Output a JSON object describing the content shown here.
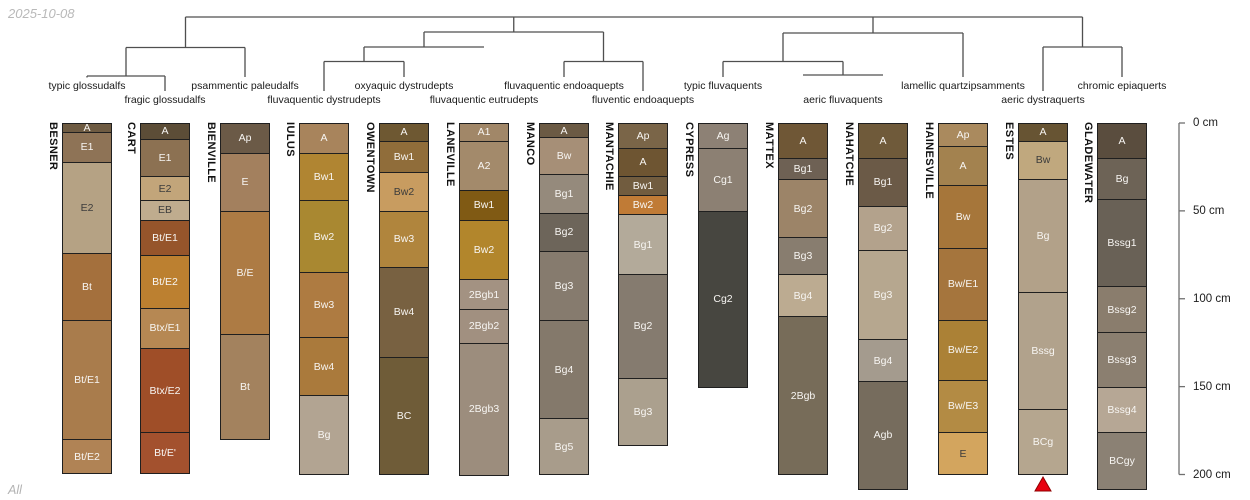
{
  "window": {
    "date": "2025-10-08",
    "footer": "All"
  },
  "dendrogram": {
    "line_color": "#4f4f4f",
    "taxa": [
      {
        "label": "typic glossudalfs",
        "x": 87,
        "row": 1
      },
      {
        "label": "fragic glossudalfs",
        "x": 165,
        "row": 2
      },
      {
        "label": "psammentic paleudalfs",
        "x": 245,
        "row": 1
      },
      {
        "label": "fluvaquentic dystrudepts",
        "x": 324,
        "row": 2
      },
      {
        "label": "oxyaquic dystrudepts",
        "x": 404,
        "row": 1
      },
      {
        "label": "fluvaquentic eutrudepts",
        "x": 484,
        "row": 2
      },
      {
        "label": "fluvaquentic endoaquepts",
        "x": 564,
        "row": 1
      },
      {
        "label": "fluventic endoaquepts",
        "x": 643,
        "row": 2
      },
      {
        "label": "typic fluvaquents",
        "x": 723,
        "row": 1
      },
      {
        "label": "aeric fluvaquents",
        "x": 843,
        "row": 2
      },
      {
        "label": "lamellic quartzipsamments",
        "x": 963,
        "row": 1
      },
      {
        "label": "aeric dystraquerts",
        "x": 1043,
        "row": 2
      },
      {
        "label": "chromic epiaquerts",
        "x": 1122,
        "row": 1
      }
    ],
    "links": {
      "h": [
        [
          17,
          185.5,
          1082.5
        ],
        [
          47.5,
          126,
          245
        ],
        [
          76,
          87,
          165
        ],
        [
          47,
          364,
          484
        ],
        [
          61.5,
          324,
          404
        ],
        [
          61.5,
          564,
          643
        ],
        [
          32,
          424,
          603.5
        ],
        [
          33,
          783,
          963
        ],
        [
          61.5,
          723,
          843
        ],
        [
          75,
          803,
          883
        ],
        [
          47,
          1043,
          1122
        ]
      ],
      "v": [
        [
          185.5,
          17,
          47.5
        ],
        [
          126,
          47.5,
          76
        ],
        [
          87,
          76,
          77.5
        ],
        [
          165,
          76,
          91
        ],
        [
          245,
          47.5,
          77
        ],
        [
          513.75,
          17,
          32
        ],
        [
          424,
          32,
          47
        ],
        [
          364,
          47,
          61.5
        ],
        [
          324,
          61.5,
          91
        ],
        [
          404,
          61.5,
          77
        ],
        [
          603.5,
          32,
          61.5
        ],
        [
          564,
          61.5,
          77
        ],
        [
          643,
          61.5,
          91
        ],
        [
          873,
          17,
          33
        ],
        [
          783,
          33,
          61.5
        ],
        [
          723,
          61.5,
          77
        ],
        [
          843,
          61.5,
          75
        ],
        [
          963,
          33,
          77
        ],
        [
          1082.5,
          17,
          47
        ],
        [
          1043,
          47,
          91
        ],
        [
          1122,
          47,
          77
        ]
      ]
    }
  },
  "depth_axis": {
    "unit": "cm",
    "color": "#707070",
    "label_color": "#1c1c1c",
    "ticks": [
      {
        "value": 0,
        "label": "0 cm"
      },
      {
        "value": 50,
        "label": "50 cm"
      },
      {
        "value": 100,
        "label": "100 cm"
      },
      {
        "value": 150,
        "label": "150 cm"
      },
      {
        "value": 200,
        "label": "200 cm"
      }
    ]
  },
  "geometry": {
    "depth_y0": 123,
    "px_per_cm": 1.7575,
    "col_width": 50,
    "axis_x": 1179,
    "taxa_row_y": [
      80,
      94
    ],
    "name_offset": 15
  },
  "marker": {
    "type": "triangle-up",
    "profile": "ESTES",
    "color": "#e8000f",
    "border": "#8f0000",
    "x": 1043,
    "y_top": 477,
    "width": 16,
    "height": 14
  },
  "profiles": [
    {
      "name": "BESNER",
      "x": 62,
      "taxon": "typic glossudalfs",
      "horizons": [
        {
          "n": "A",
          "t": 0,
          "b": 5,
          "c": "#6e5b42"
        },
        {
          "n": "E1",
          "t": 5,
          "b": 22,
          "c": "#8e7356"
        },
        {
          "n": "E2",
          "t": 22,
          "b": 74,
          "c": "#b5a284",
          "dk": 1
        },
        {
          "n": "Bt",
          "t": 74,
          "b": 112,
          "c": "#a4703d"
        },
        {
          "n": "Bt/E1",
          "t": 112,
          "b": 180,
          "c": "#a97c4c"
        },
        {
          "n": "Bt/E2",
          "t": 180,
          "b": 199,
          "c": "#b08355"
        }
      ]
    },
    {
      "name": "CART",
      "x": 140,
      "taxon": "fragic glossudalfs",
      "horizons": [
        {
          "n": "A",
          "t": 0,
          "b": 9,
          "c": "#5c4d37"
        },
        {
          "n": "E1",
          "t": 9,
          "b": 30,
          "c": "#8c7152"
        },
        {
          "n": "E2",
          "t": 30,
          "b": 44,
          "c": "#c2a57a",
          "dk": 1
        },
        {
          "n": "EB",
          "t": 44,
          "b": 55,
          "c": "#bfac8e",
          "dk": 1
        },
        {
          "n": "Bt/E1",
          "t": 55,
          "b": 75,
          "c": "#96552b"
        },
        {
          "n": "Bt/E2",
          "t": 75,
          "b": 105,
          "c": "#bc8030"
        },
        {
          "n": "Btx/E1",
          "t": 105,
          "b": 128,
          "c": "#b68853"
        },
        {
          "n": "Btx/E2",
          "t": 128,
          "b": 176,
          "c": "#9f4e28"
        },
        {
          "n": "Bt/E'",
          "t": 176,
          "b": 199,
          "c": "#a3512e"
        }
      ]
    },
    {
      "name": "BIENVILLE",
      "x": 220,
      "taxon": "psammentic paleudalfs",
      "horizons": [
        {
          "n": "Ap",
          "t": 0,
          "b": 17,
          "c": "#6b5a47"
        },
        {
          "n": "E",
          "t": 17,
          "b": 50,
          "c": "#a3805e"
        },
        {
          "n": "B/E",
          "t": 50,
          "b": 120,
          "c": "#ad7b44"
        },
        {
          "n": "Bt",
          "t": 120,
          "b": 180,
          "c": "#a3825e"
        }
      ]
    },
    {
      "name": "IULUS",
      "x": 299,
      "taxon": "fluvaquentic dystrudepts",
      "horizons": [
        {
          "n": "A",
          "t": 0,
          "b": 17,
          "c": "#a8845c"
        },
        {
          "n": "Bw1",
          "t": 17,
          "b": 44,
          "c": "#b08532"
        },
        {
          "n": "Bw2",
          "t": 44,
          "b": 85,
          "c": "#a98831"
        },
        {
          "n": "Bw3",
          "t": 85,
          "b": 122,
          "c": "#ae7b41"
        },
        {
          "n": "Bw4",
          "t": 122,
          "b": 155,
          "c": "#aa7a3c"
        },
        {
          "n": "Bg",
          "t": 155,
          "b": 200,
          "c": "#b2a492"
        }
      ]
    },
    {
      "name": "OWENTOWN",
      "x": 379,
      "taxon": "oxyaquic dystrudepts",
      "horizons": [
        {
          "n": "A",
          "t": 0,
          "b": 10,
          "c": "#6e5832"
        },
        {
          "n": "Bw1",
          "t": 10,
          "b": 28,
          "c": "#906d3a"
        },
        {
          "n": "Bw2",
          "t": 28,
          "b": 50,
          "c": "#c89c60",
          "dk": 1
        },
        {
          "n": "Bw3",
          "t": 50,
          "b": 82,
          "c": "#b0853d"
        },
        {
          "n": "Bw4",
          "t": 82,
          "b": 133,
          "c": "#786141"
        },
        {
          "n": "BC",
          "t": 133,
          "b": 200,
          "c": "#6f5c38"
        }
      ]
    },
    {
      "name": "LANEVILLE",
      "x": 459,
      "taxon": "fluvaquentic eutrudepts",
      "horizons": [
        {
          "n": "A1",
          "t": 0,
          "b": 10,
          "c": "#a18768"
        },
        {
          "n": "A2",
          "t": 10,
          "b": 38,
          "c": "#a38a6b"
        },
        {
          "n": "Bw1",
          "t": 38,
          "b": 55,
          "c": "#805a14"
        },
        {
          "n": "Bw2",
          "t": 55,
          "b": 89,
          "c": "#b2862c"
        },
        {
          "n": "2Bgb1",
          "t": 89,
          "b": 106,
          "c": "#a39282"
        },
        {
          "n": "2Bgb2",
          "t": 106,
          "b": 125,
          "c": "#a19080"
        },
        {
          "n": "2Bgb3",
          "t": 125,
          "b": 200,
          "c": "#9c8d7d"
        }
      ]
    },
    {
      "name": "MANCO",
      "x": 539,
      "taxon": "fluvaquentic endoaquepts",
      "horizons": [
        {
          "n": "A",
          "t": 0,
          "b": 8,
          "c": "#6b5a44"
        },
        {
          "n": "Bw",
          "t": 8,
          "b": 29,
          "c": "#a68f77"
        },
        {
          "n": "Bg1",
          "t": 29,
          "b": 51,
          "c": "#958a7c"
        },
        {
          "n": "Bg2",
          "t": 51,
          "b": 73,
          "c": "#6d655a"
        },
        {
          "n": "Bg3",
          "t": 73,
          "b": 112,
          "c": "#867b6e"
        },
        {
          "n": "Bg4",
          "t": 112,
          "b": 168,
          "c": "#84796b"
        },
        {
          "n": "Bg5",
          "t": 168,
          "b": 200,
          "c": "#a89c8b"
        }
      ]
    },
    {
      "name": "MANTACHIE",
      "x": 618,
      "taxon": "fluventic endoaquepts",
      "horizons": [
        {
          "n": "Ap",
          "t": 0,
          "b": 14,
          "c": "#7a6548"
        },
        {
          "n": "A",
          "t": 14,
          "b": 30,
          "c": "#6e5532"
        },
        {
          "n": "Bw1",
          "t": 30,
          "b": 41,
          "c": "#715c3f"
        },
        {
          "n": "Bw2",
          "t": 41,
          "b": 52,
          "c": "#c07b36"
        },
        {
          "n": "Bg1",
          "t": 52,
          "b": 86,
          "c": "#b3aa9a"
        },
        {
          "n": "Bg2",
          "t": 86,
          "b": 145,
          "c": "#857b6f"
        },
        {
          "n": "Bg3",
          "t": 145,
          "b": 183,
          "c": "#aba08e"
        }
      ]
    },
    {
      "name": "CYPRESS",
      "x": 698,
      "taxon": "typic fluvaquents",
      "horizons": [
        {
          "n": "Ag",
          "t": 0,
          "b": 14,
          "c": "#8d8175"
        },
        {
          "n": "Cg1",
          "t": 14,
          "b": 50,
          "c": "#8c8073"
        },
        {
          "n": "Cg2",
          "t": 50,
          "b": 150,
          "c": "#474640"
        }
      ]
    },
    {
      "name": "MATTEX",
      "x": 778,
      "taxon": "aeric fluvaquents",
      "horizons": [
        {
          "n": "A",
          "t": 0,
          "b": 20,
          "c": "#6f5736"
        },
        {
          "n": "Bg1",
          "t": 20,
          "b": 32,
          "c": "#6e6154"
        },
        {
          "n": "Bg2",
          "t": 32,
          "b": 65,
          "c": "#9c8468"
        },
        {
          "n": "Bg3",
          "t": 65,
          "b": 86,
          "c": "#887d6f"
        },
        {
          "n": "Bg4",
          "t": 86,
          "b": 110,
          "c": "#bcab91"
        },
        {
          "n": "2Bgb",
          "t": 110,
          "b": 200,
          "c": "#776c59"
        }
      ]
    },
    {
      "name": "NAHATCHE",
      "x": 858,
      "taxon": "aeric fluvaquents",
      "horizons": [
        {
          "n": "A",
          "t": 0,
          "b": 20,
          "c": "#6f5a3a"
        },
        {
          "n": "Bg1",
          "t": 20,
          "b": 47,
          "c": "#6b5a47"
        },
        {
          "n": "Bg2",
          "t": 47,
          "b": 72,
          "c": "#b3a28c"
        },
        {
          "n": "Bg3",
          "t": 72,
          "b": 123,
          "c": "#b6a78f"
        },
        {
          "n": "Bg4",
          "t": 123,
          "b": 147,
          "c": "#a49b8e"
        },
        {
          "n": "Agb",
          "t": 147,
          "b": 208,
          "c": "#766c5d"
        }
      ]
    },
    {
      "name": "HAINESVILLE",
      "x": 938,
      "taxon": "lamellic quartzipsamments",
      "horizons": [
        {
          "n": "Ap",
          "t": 0,
          "b": 13,
          "c": "#aa8a5e"
        },
        {
          "n": "A",
          "t": 13,
          "b": 35,
          "c": "#a3824f"
        },
        {
          "n": "Bw",
          "t": 35,
          "b": 71,
          "c": "#a6763a"
        },
        {
          "n": "Bw/E1",
          "t": 71,
          "b": 112,
          "c": "#a5753d"
        },
        {
          "n": "Bw/E2",
          "t": 112,
          "b": 146,
          "c": "#ab8136"
        },
        {
          "n": "Bw/E3",
          "t": 146,
          "b": 176,
          "c": "#b38b44"
        },
        {
          "n": "E",
          "t": 176,
          "b": 200,
          "c": "#d3a55e",
          "dk": 1
        }
      ]
    },
    {
      "name": "ESTES",
      "x": 1018,
      "taxon": "aeric dystraquerts",
      "horizons": [
        {
          "n": "A",
          "t": 0,
          "b": 10,
          "c": "#675433"
        },
        {
          "n": "Bw",
          "t": 10,
          "b": 32,
          "c": "#c0a87e",
          "dk": 1
        },
        {
          "n": "Bg",
          "t": 32,
          "b": 96,
          "c": "#b2a189"
        },
        {
          "n": "Bssg",
          "t": 96,
          "b": 163,
          "c": "#b1a28c"
        },
        {
          "n": "BCg",
          "t": 163,
          "b": 200,
          "c": "#b5a68f"
        }
      ]
    },
    {
      "name": "GLADEWATER",
      "x": 1097,
      "taxon": "chromic epiaquerts",
      "horizons": [
        {
          "n": "A",
          "t": 0,
          "b": 20,
          "c": "#5a4d3e"
        },
        {
          "n": "Bg",
          "t": 20,
          "b": 43,
          "c": "#6d6356"
        },
        {
          "n": "Bssg1",
          "t": 43,
          "b": 93,
          "c": "#696156"
        },
        {
          "n": "Bssg2",
          "t": 93,
          "b": 119,
          "c": "#8a7d6d"
        },
        {
          "n": "Bssg3",
          "t": 119,
          "b": 150,
          "c": "#8b7f70"
        },
        {
          "n": "Bssg4",
          "t": 150,
          "b": 176,
          "c": "#b6a795"
        },
        {
          "n": "BCgy",
          "t": 176,
          "b": 208,
          "c": "#8b8174"
        }
      ]
    }
  ]
}
